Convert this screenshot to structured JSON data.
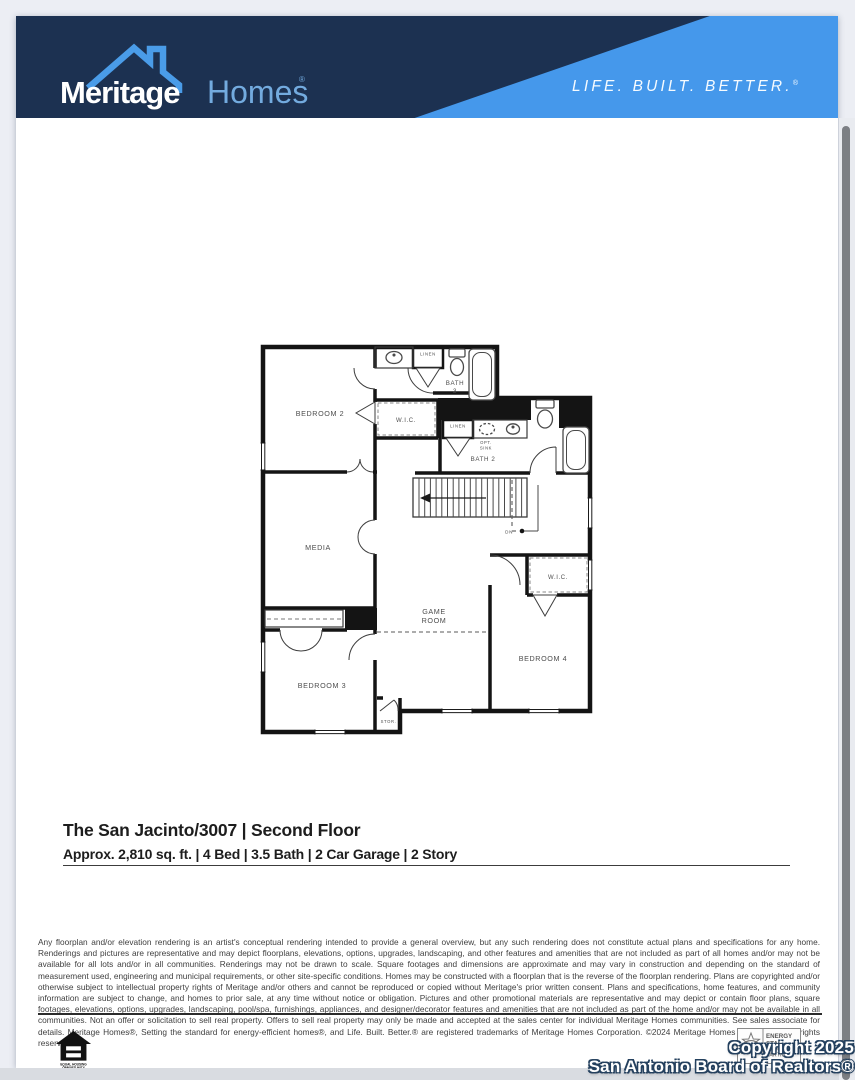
{
  "header": {
    "brand_bold": "Meritage",
    "brand_serif": "Homes",
    "reg_mark": "®",
    "tagline": "LIFE. BUILT. BETTER.",
    "tagline_reg": "®",
    "colors": {
      "navy": "#1c3151",
      "light_blue": "#4598eb",
      "roof_blue": "#4a9ce8"
    }
  },
  "floorplan": {
    "labels": {
      "bedroom2": "BEDROOM 2",
      "bath3_l1": "BATH",
      "bath3_l2": "3",
      "linen_a": "LINEN",
      "wic_a": "W.I.C.",
      "linen_b": "LINEN",
      "opt_l1": "OPT.",
      "opt_l2": "SINK",
      "bath2": "BATH 2",
      "media": "MEDIA",
      "game_l1": "GAME",
      "game_l2": "ROOM",
      "bedroom3": "BEDROOM 3",
      "bedroom4": "BEDROOM 4",
      "wic_b": "W.I.C.",
      "stor": "STOR.",
      "dn": "DN"
    }
  },
  "title_block": {
    "title": "The San Jacinto/3007 | Second Floor",
    "subtitle": "Approx. 2,810 sq. ft. | 4 Bed | 3.5 Bath | 2 Car Garage | 2 Story"
  },
  "disclaimer": "Any floorplan and/or elevation rendering is an artist's conceptual rendering intended to provide a general overview, but any such rendering does not constitute actual plans and specifications for any home. Renderings and pictures are representative and may depict floorplans, elevations, options, upgrades, landscaping, and other features and amenities that are not included as part of all homes and/or may not be available for all lots and/or in all communities. Renderings may not be drawn to scale. Square footages and dimensions are approximate and may vary in construction and depending on the standard of measurement used, engineering and municipal requirements, or other site-specific conditions.  Homes may be constructed with a floorplan that is the reverse of the floorplan rendering. Plans are copyrighted and/or otherwise subject to intellectual property rights of Meritage and/or others and cannot be reproduced or copied without Meritage's prior written consent. Plans and specifications, home features, and community information are subject to change, and homes to prior sale, at any time without notice or obligation. Pictures and other promotional materials are representative and may depict or contain floor plans, square footages, elevations, options, upgrades, landscaping, pool/spa, furnishings, appliances, and designer/decorator features and amenities that are not included as part of the home and/or may not be available in all communities. Not an offer or solicitation to sell real property. Offers to sell real property may only be made and accepted at the sales center for individual Meritage Homes communities. See sales associate for details. Meritage Homes®, Setting the standard for energy-efficient homes®, and Life. Built. Better.® are registered trademarks of Meritage Homes Corporation. ©2024 Meritage Homes Corporation. All rights reserved.",
  "footer": {
    "equal_housing_l1": "EQUAL HOUSING",
    "equal_housing_l2": "OPPORTUNITY",
    "energy_star_l1": "ENERGY",
    "energy_star_l2": "STAR",
    "energy_star_l3": "PARTNER",
    "watermark_l1": "Copyright 2025",
    "watermark_l2": "San Antonio Board of Realtors®"
  }
}
